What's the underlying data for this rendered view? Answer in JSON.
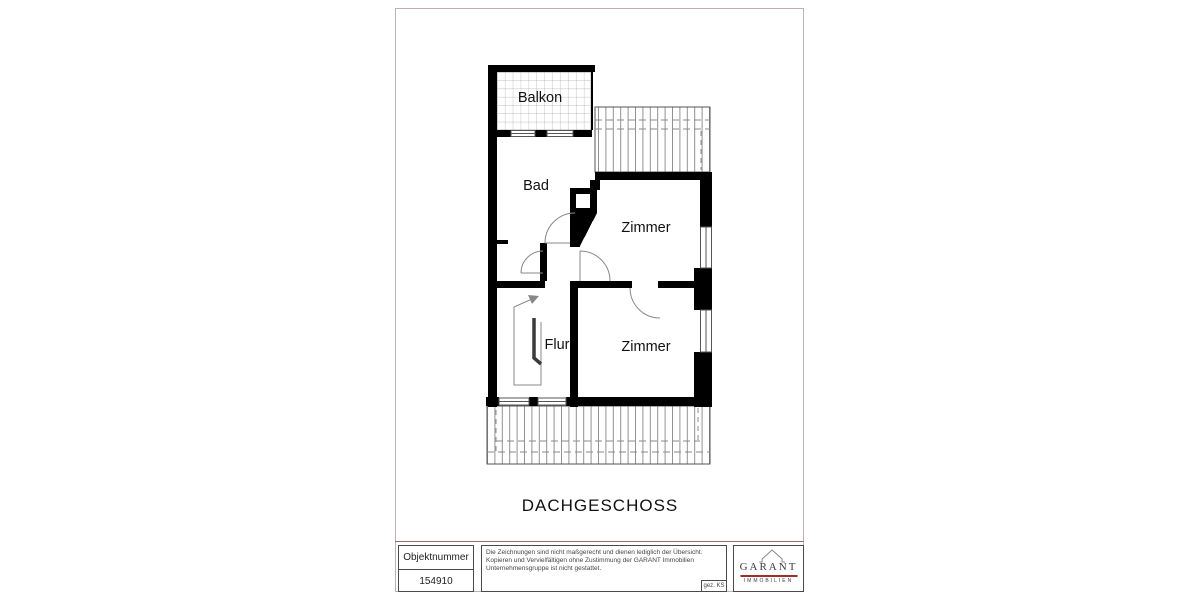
{
  "plan": {
    "floor_title": "DACHGESCHOSS",
    "rooms": [
      {
        "label": "Balkon"
      },
      {
        "label": "Bad"
      },
      {
        "label": "Zimmer"
      },
      {
        "label": "Flur"
      },
      {
        "label": "Zimmer"
      }
    ]
  },
  "title_block": {
    "object_number_label": "Objektnummer",
    "object_number_value": "154910",
    "disclaimer_lines": [
      "Die Zeichnungen sind nicht maßgerecht und dienen lediglich der Übersicht.",
      "Kopieren und Vervielfältigen ohne Zustimmung der GARANT Immobilien",
      "Unternehmensgruppe ist nicht gestattet."
    ],
    "drawn_by": "gez. KS",
    "logo": {
      "brand": "GARANT",
      "subtitle": "IMMOBILIEN"
    }
  },
  "colors": {
    "wall": "#000000",
    "frame_border": "#c2b0b0",
    "logo_accent_red": "#a02c2a",
    "logo_text": "#3b3b44"
  }
}
